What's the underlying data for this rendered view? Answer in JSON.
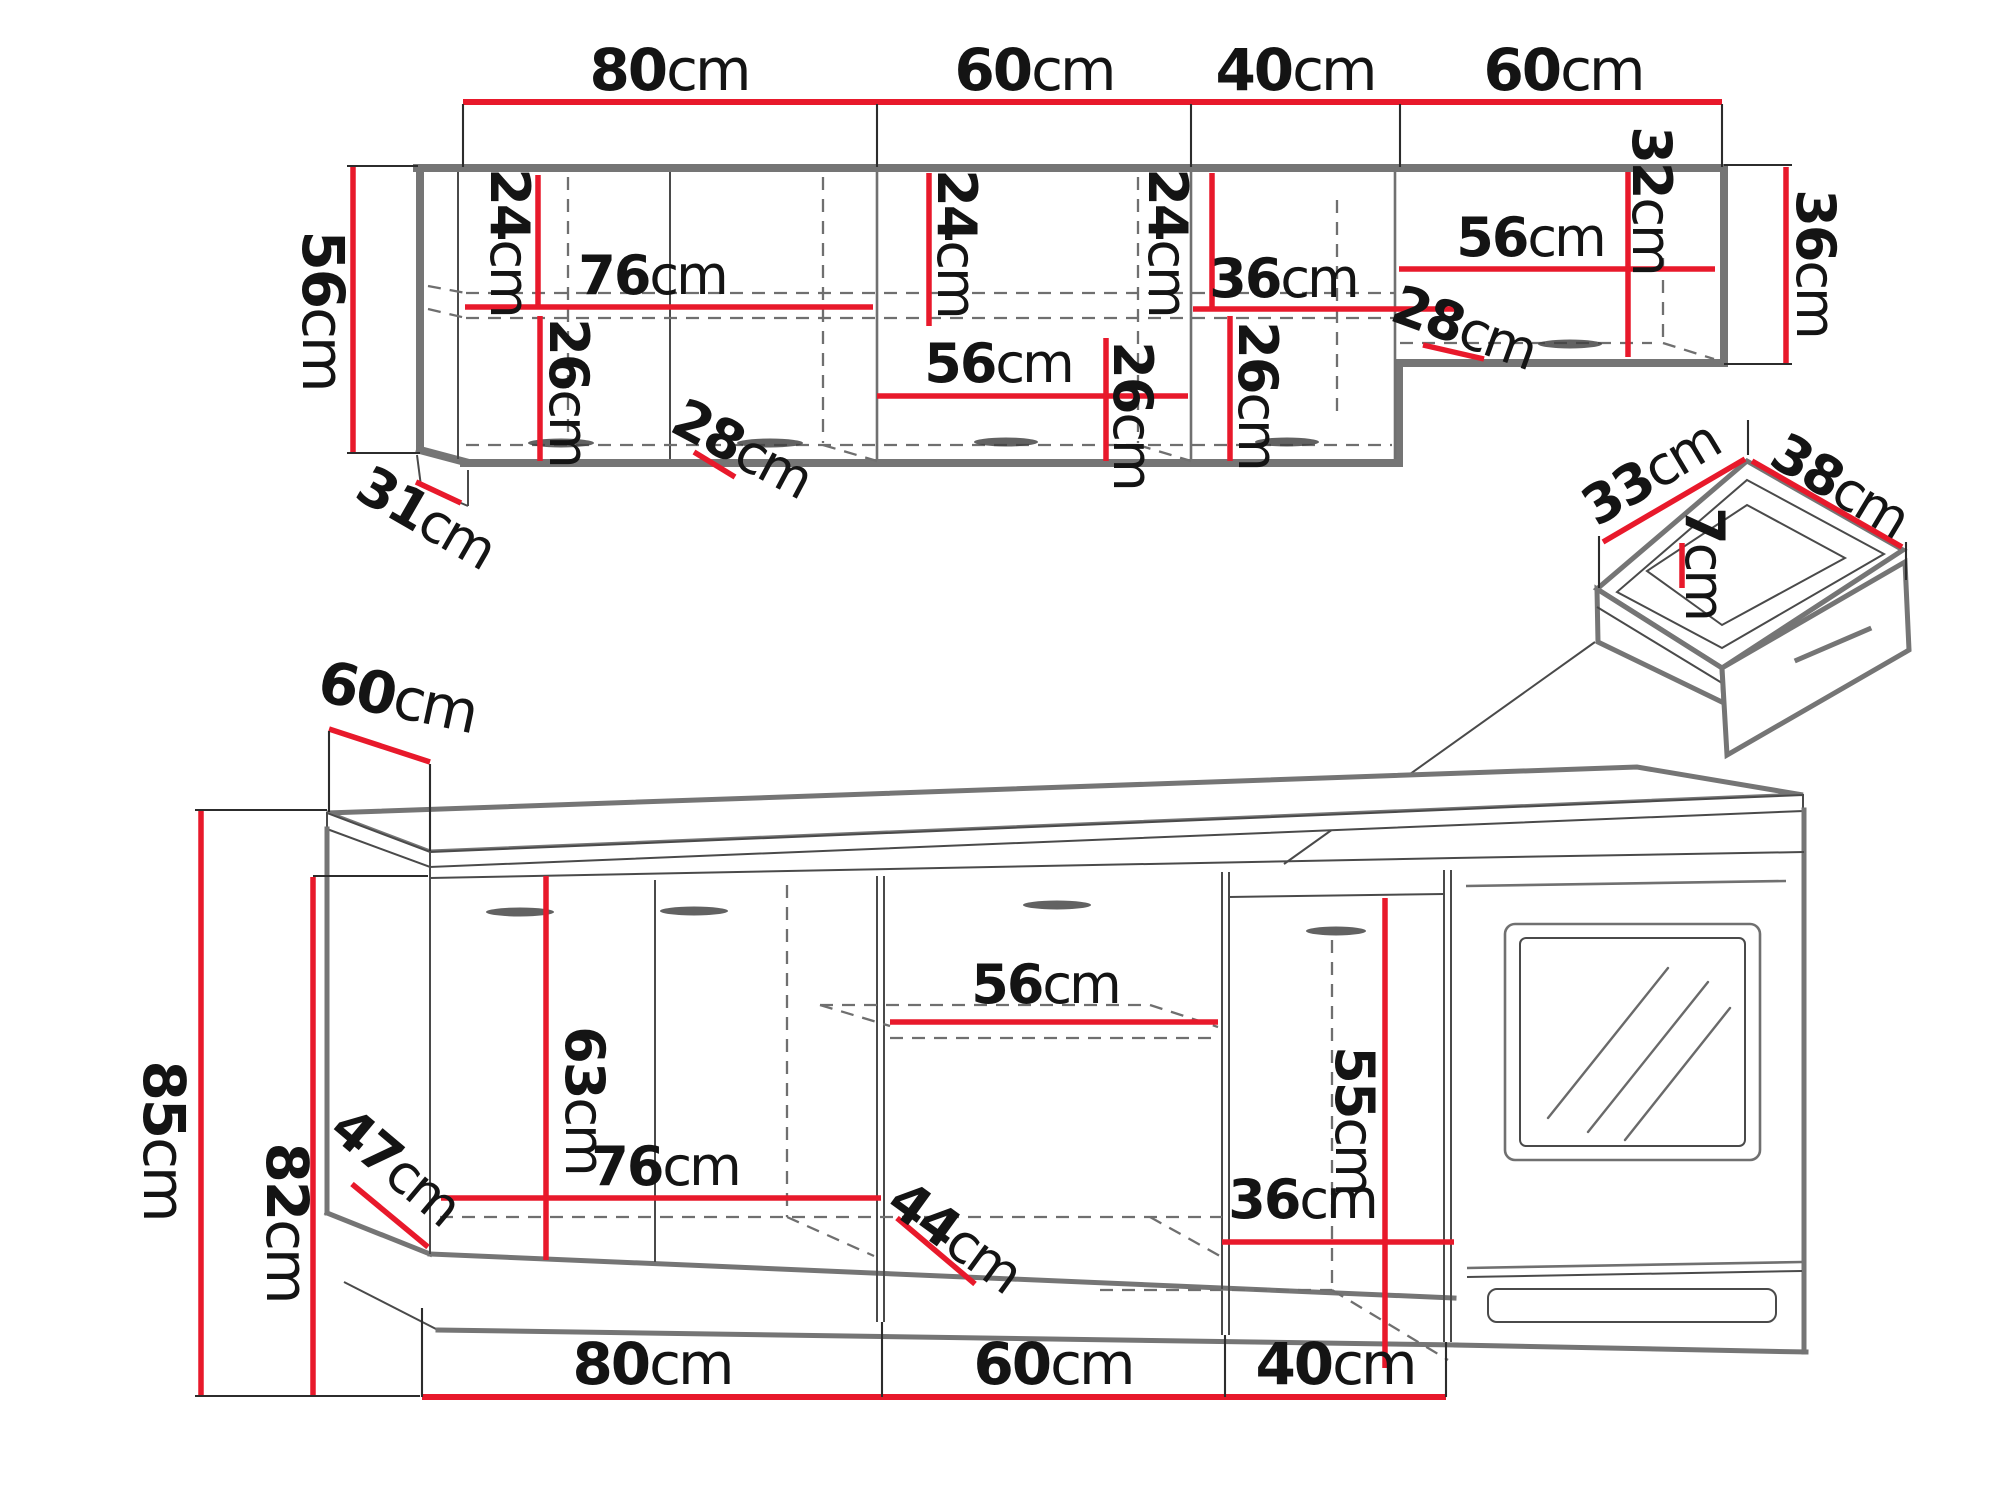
{
  "diagram_title": "kitchen cabinet set dimension drawing",
  "colors": {
    "dimension_red": "#e8192b",
    "cabinet_outline_gray": "#757575",
    "detail_line_gray": "#4a4a4a",
    "dashed_depth_gray": "#6f6f6f",
    "label_black": "#141414",
    "background": "#ffffff"
  },
  "upper_run": {
    "width_dims": [
      {
        "n": "80",
        "u": "cm"
      },
      {
        "n": "60",
        "u": "cm"
      },
      {
        "n": "40",
        "u": "cm"
      },
      {
        "n": "60",
        "u": "cm"
      }
    ],
    "height_dim": {
      "n": "56",
      "u": "cm"
    },
    "side_depth_dim": {
      "n": "31",
      "u": "cm"
    },
    "right_height_dim": {
      "n": "36",
      "u": "cm"
    },
    "sec1_top_dim": {
      "n": "24",
      "u": "cm"
    },
    "sec1_shelf_dim": {
      "n": "76",
      "u": "cm"
    },
    "sec1_bottom_dim": {
      "n": "26",
      "u": "cm"
    },
    "sec1_depth_dim": {
      "n": "28",
      "u": "cm"
    },
    "sec2_top_dim": {
      "n": "24",
      "u": "cm"
    },
    "sec2_shelf_dim": {
      "n": "56",
      "u": "cm"
    },
    "sec2_bottom_dim": {
      "n": "26",
      "u": "cm"
    },
    "sec3_top_dim": {
      "n": "24",
      "u": "cm"
    },
    "sec3_width_dim": {
      "n": "36",
      "u": "cm"
    },
    "sec3_bottom_dim": {
      "n": "26",
      "u": "cm"
    },
    "sec4_shelf_dim": {
      "n": "56",
      "u": "cm"
    },
    "sec4_height_dim": {
      "n": "32",
      "u": "cm"
    },
    "sec4_depth_dim": {
      "n": "28",
      "u": "cm"
    }
  },
  "drawer_detail": {
    "width_dim": {
      "n": "33",
      "u": "cm"
    },
    "depth_dim": {
      "n": "38",
      "u": "cm"
    },
    "height_dim": {
      "n": "7",
      "u": "cm"
    }
  },
  "base_run": {
    "counter_depth_dim": {
      "n": "60",
      "u": "cm"
    },
    "total_height_dim": {
      "n": "85",
      "u": "cm"
    },
    "carcass_height_dim": {
      "n": "82",
      "u": "cm"
    },
    "corner_front_dim": {
      "n": "47",
      "u": "cm"
    },
    "door_height_dim": {
      "n": "63",
      "u": "cm"
    },
    "shelf_width_dim": {
      "n": "56",
      "u": "cm"
    },
    "interior_width_dim": {
      "n": "76",
      "u": "cm"
    },
    "corner_depth_dim": {
      "n": "44",
      "u": "cm"
    },
    "right_height_dim": {
      "n": "55",
      "u": "cm"
    },
    "right_width_dim": {
      "n": "36",
      "u": "cm"
    },
    "width_dims": [
      {
        "n": "80",
        "u": "cm"
      },
      {
        "n": "60",
        "u": "cm"
      },
      {
        "n": "40",
        "u": "cm"
      }
    ]
  }
}
